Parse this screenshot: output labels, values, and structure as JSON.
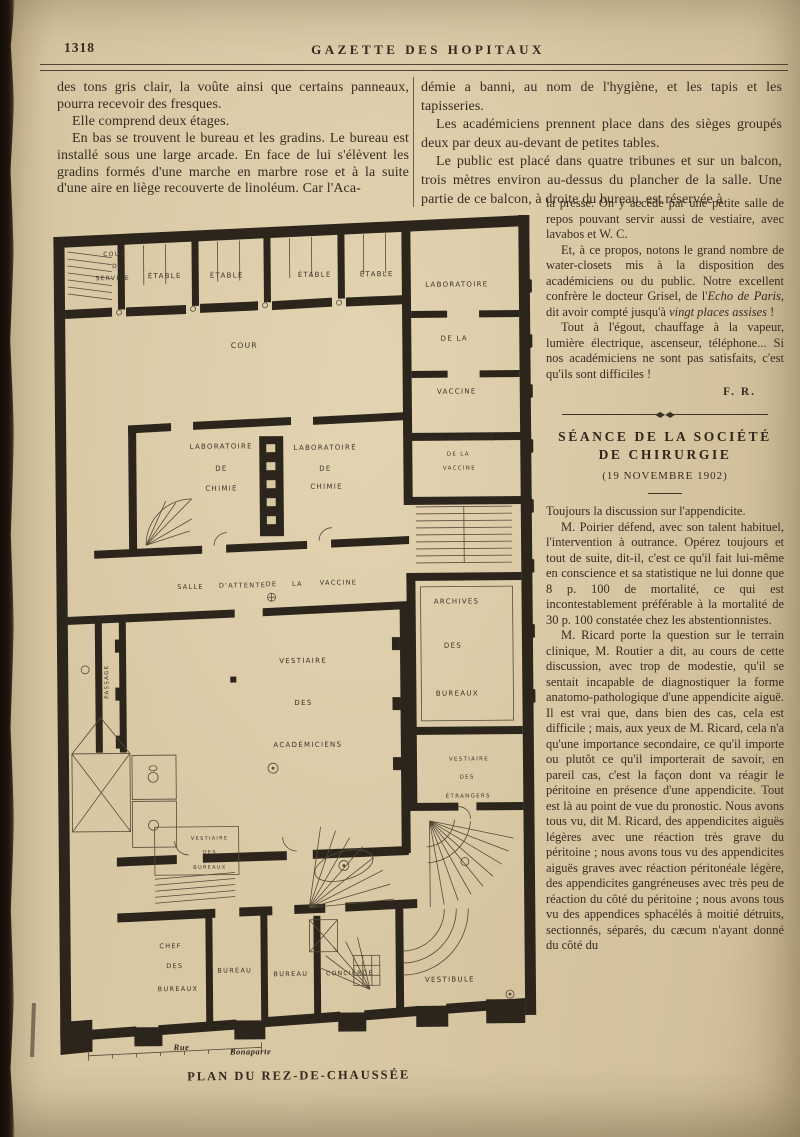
{
  "page": {
    "number": "1318",
    "journal_title": "GAZETTE DES HOPITAUX"
  },
  "left_column": {
    "paragraphs": [
      "des tons gris clair, la voûte ainsi que certains panneaux, pourra recevoir des fresques.",
      "Elle comprend deux étages.",
      "En bas se trouvent le bureau et les gradins. Le bureau est installé sous une large arcade. En face de lui s'élèvent les gradins formés d'une marche en marbre rose et à la suite d'une aire en liège recouverte de linoléum. Car l'Aca-"
    ]
  },
  "right_column": {
    "wide_paragraphs": [
      "démie a banni, au nom de l'hygiène, et les tapis et les tapisseries.",
      "Les académiciens prennent place dans des sièges groupés deux par deux au-devant de petites tables.",
      "Le public est placé dans quatre tribunes et sur un balcon, trois mètres environ au-dessus du plancher de la salle. Une partie de ce balcon, à droite du bureau, est réservée à"
    ],
    "narrow_paragraphs": [
      [
        {
          "t": "la presse. On y accède par une petite salle de repos pouvant servir aussi de vestiaire, avec lavabos et W. C."
        }
      ],
      [
        {
          "t": "Et, à ce propos, notons le grand nombre de water-closets mis à la disposition des académiciens ou du public. Notre excellent confrère le docteur Grisel, de l'"
        },
        {
          "t": "Echo de Paris",
          "i": true
        },
        {
          "t": ", dit avoir compté jusqu'à "
        },
        {
          "t": "vingt places assises",
          "i": true
        },
        {
          "t": " !"
        }
      ],
      [
        {
          "t": "Tout à l'égout, chauffage à la vapeur, lumière électrique, ascenseur, téléphone... Si nos académiciens ne sont pas satisfaits, c'est qu'ils sont difficiles !"
        }
      ]
    ],
    "signature": "F. R.",
    "section": {
      "title_line1": "SÉANCE DE LA SOCIÉTÉ",
      "title_line2": "DE CHIRURGIE",
      "date": "(19 NOVEMBRE 1902)",
      "paragraphs": [
        [
          {
            "t": "Toujours la discussion sur l'appendicite."
          }
        ],
        [
          {
            "t": "M. Poirier défend, avec son talent habituel, l'intervention à outrance. Opérez toujours et tout de suite, dit-il, c'est ce qu'il fait lui-même en conscience et sa statistique ne lui donne que 8 p. 100 de mortalité, ce qui est incontestablement préférable à la mortalité de 30 p. 100 constatée chez les abstentionnistes."
          }
        ],
        [
          {
            "t": "M. Ricard porte la question sur le terrain clinique, M. Routier a dit, au cours de cette discussion, avec trop de modestie, qu'il se sentait incapable de diagnostiquer la forme anatomo-pathologique d'une appendicite aiguë. Il est vrai que, dans bien des cas, cela est difficile ; mais, aux yeux de M. Ricard, cela n'a qu'une importance secondaire, ce qu'il importe ou plutôt ce qu'il importerait de savoir, en pareil cas, c'est la façon dont va réagir le péritoine en présence d'une appendicite. Tout est là au point de vue du pronostic. Nous avons tous vu, dit M. Ricard, des appendicites aiguës légères avec une réaction très grave du péritoine ; nous avons tous vu des appendicites aiguës graves avec réaction péritonéale légère, des appendicites gangréneuses avec très peu de réaction du côté du péritoine ; nous avons tous vu des appendices sphacélés à moitié détruits, sectionnés, séparés, du cæcum n'ayant donné du côté du"
          }
        ]
      ]
    }
  },
  "plan": {
    "caption": "PLAN DU REZ-DE-CHAUSSÉE",
    "labels": [
      {
        "text": "COUR",
        "x": 63,
        "y": 45,
        "s": 6
      },
      {
        "text": "DE",
        "x": 66,
        "y": 57,
        "s": 6
      },
      {
        "text": "SERVICE",
        "x": 61,
        "y": 69,
        "s": 6
      },
      {
        "text": "ÉTABLE",
        "x": 113,
        "y": 67
      },
      {
        "text": "ÉTABLE",
        "x": 175,
        "y": 67
      },
      {
        "text": "ÉTABLE",
        "x": 263,
        "y": 67
      },
      {
        "text": "ÉTABLE",
        "x": 325,
        "y": 67
      },
      {
        "text": "COUR",
        "x": 192,
        "y": 137,
        "s": 7.5
      },
      {
        "text": "LABORATOIRE",
        "x": 405,
        "y": 78
      },
      {
        "text": "DE LA",
        "x": 402,
        "y": 132
      },
      {
        "text": "VACCINE",
        "x": 404,
        "y": 185
      },
      {
        "text": "LABORATOIRE",
        "x": 168,
        "y": 238
      },
      {
        "text": "DE",
        "x": 168,
        "y": 260
      },
      {
        "text": "CHIMIE",
        "x": 168,
        "y": 280
      },
      {
        "text": "LABORATOIRE",
        "x": 272,
        "y": 240
      },
      {
        "text": "DE",
        "x": 272,
        "y": 261
      },
      {
        "text": "CHIMIE",
        "x": 273,
        "y": 279
      },
      {
        "text": "CHEF DE SERVICE",
        "x": 407,
        "y": 233,
        "s": 5.5
      },
      {
        "text": "DE LA",
        "x": 405,
        "y": 248,
        "s": 5.5
      },
      {
        "text": "VACCINE",
        "x": 406,
        "y": 262,
        "s": 5.5
      },
      {
        "text": "SALLE",
        "x": 136,
        "y": 378,
        "s": 6.5
      },
      {
        "text": "D'ATTENTE",
        "x": 188,
        "y": 377,
        "s": 6.5
      },
      {
        "text": "DE",
        "x": 217,
        "y": 376,
        "s": 6.5
      },
      {
        "text": "LA",
        "x": 243,
        "y": 376,
        "s": 6.5
      },
      {
        "text": "VACCINE",
        "x": 284,
        "y": 375,
        "s": 6.5
      },
      {
        "text": "ARCHIVES",
        "x": 402,
        "y": 395
      },
      {
        "text": "DES",
        "x": 398,
        "y": 439
      },
      {
        "text": "BUREAUX",
        "x": 402,
        "y": 487
      },
      {
        "text": "VESTIAIRE",
        "x": 248,
        "y": 453
      },
      {
        "text": "DES",
        "x": 248,
        "y": 495
      },
      {
        "text": "ACADÉMICIENS",
        "x": 252,
        "y": 537
      },
      {
        "text": "PASSAGE",
        "x": 52,
        "y": 472,
        "s": 5.5,
        "rot": -90
      },
      {
        "text": "VESTIAIRE",
        "x": 413,
        "y": 553,
        "s": 5.5
      },
      {
        "text": "DES",
        "x": 411,
        "y": 571,
        "s": 5.5
      },
      {
        "text": "ÉTRANGERS",
        "x": 412,
        "y": 590,
        "s": 5.5
      },
      {
        "text": "VESTIAIRE",
        "x": 153,
        "y": 630,
        "s": 5
      },
      {
        "text": "DES",
        "x": 153,
        "y": 644,
        "s": 5
      },
      {
        "text": "BUREAUX",
        "x": 153,
        "y": 659,
        "s": 5
      },
      {
        "text": "CHEF",
        "x": 113,
        "y": 737,
        "s": 6.5
      },
      {
        "text": "DES",
        "x": 117,
        "y": 757,
        "s": 6.5
      },
      {
        "text": "BUREAUX",
        "x": 120,
        "y": 780,
        "s": 6.5
      },
      {
        "text": "BUREAU",
        "x": 177,
        "y": 762,
        "s": 6.5
      },
      {
        "text": "BUREAU",
        "x": 233,
        "y": 766,
        "s": 6.5
      },
      {
        "text": "CONCIERGE",
        "x": 292,
        "y": 766,
        "s": 6
      },
      {
        "text": "VESTIBULE",
        "x": 392,
        "y": 773,
        "s": 7
      },
      {
        "text": "Rue",
        "x": 123,
        "y": 838,
        "s": 8.5,
        "serifItalic": true
      },
      {
        "text": "Bonaparte",
        "x": 192,
        "y": 843,
        "s": 8.5,
        "serifItalic": true
      }
    ]
  }
}
